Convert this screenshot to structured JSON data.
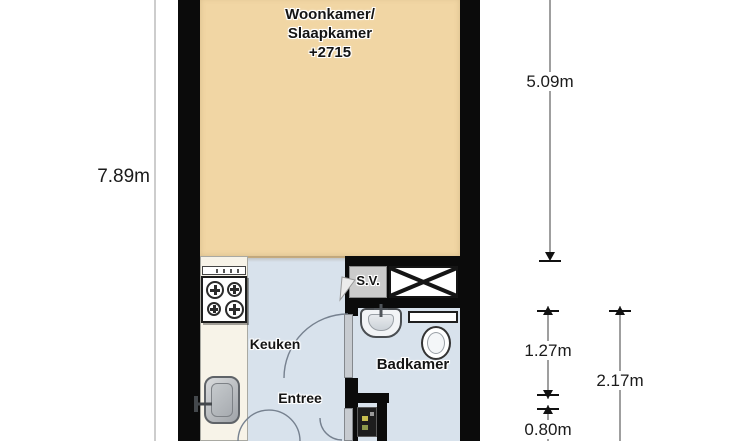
{
  "rooms": {
    "living_bedroom": {
      "line1": "Woonkamer/",
      "line2": "Slaapkamer",
      "line3": "+2715"
    },
    "kitchen": {
      "label": "Keuken"
    },
    "entry": {
      "label": "Entree"
    },
    "bathroom": {
      "label": "Badkamer"
    },
    "shaft": {
      "label": "S.V."
    }
  },
  "dimensions": {
    "left_total_height": "7.89m",
    "living_section_height": "5.09m",
    "bathroom_upper_section": "1.27m",
    "bathroom_lower_section": "0.80m",
    "bathroom_total_height": "2.17m"
  },
  "colors": {
    "living_floor": "#F1D6A4",
    "wet_room_floor": "#D8E2EC",
    "wall": "#0B0B0B",
    "kitchen_counter": "#F7F3E8"
  }
}
